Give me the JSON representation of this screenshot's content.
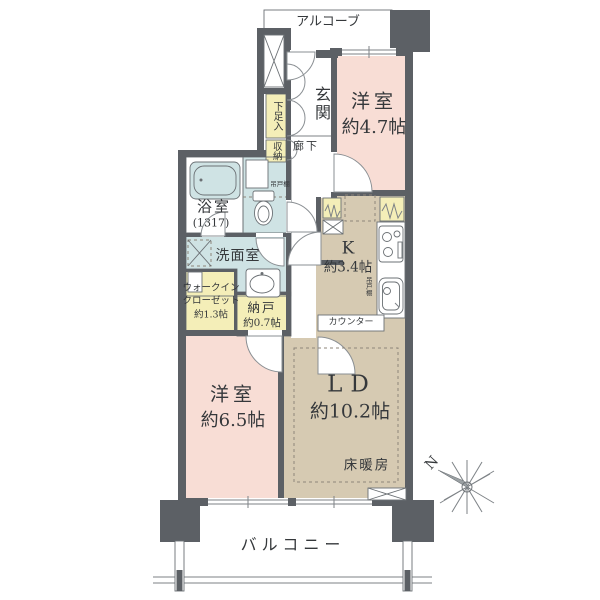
{
  "plan": {
    "alcove": "アルコーブ",
    "entrance": "玄関",
    "shoe_cabinet": "下足入",
    "hall_storage": "収納",
    "corridor": "廊下",
    "bedroom1": {
      "name": "洋室",
      "size": "約4.7帖"
    },
    "bathroom": {
      "name": "浴室",
      "size": "(1317)"
    },
    "toilet_shelf": "吊戸棚",
    "washroom": "洗面室",
    "wic": {
      "line1": "ウォークイン",
      "line2": "クローゼット",
      "line3": "約1.3帖"
    },
    "storage_room": {
      "name": "納戸",
      "size": "約0.7帖"
    },
    "kitchen": {
      "name": "K",
      "size": "約3.4帖",
      "shelf": "吊戸棚",
      "counter": "カウンター"
    },
    "ld": {
      "name": "LD",
      "size": "約10.2帖",
      "floor_heating": "床暖房"
    },
    "bedroom2": {
      "name": "洋室",
      "size": "約6.5帖"
    },
    "balcony": "バルコニー",
    "compass_north": "N"
  },
  "colors": {
    "wall": "#5c6065",
    "pink": "#f8ddd5",
    "beige": "#d6cab2",
    "blue": "#cfe3e4",
    "yellow": "#f4eeb8",
    "line": "#6b7074",
    "text": "#35383b"
  }
}
